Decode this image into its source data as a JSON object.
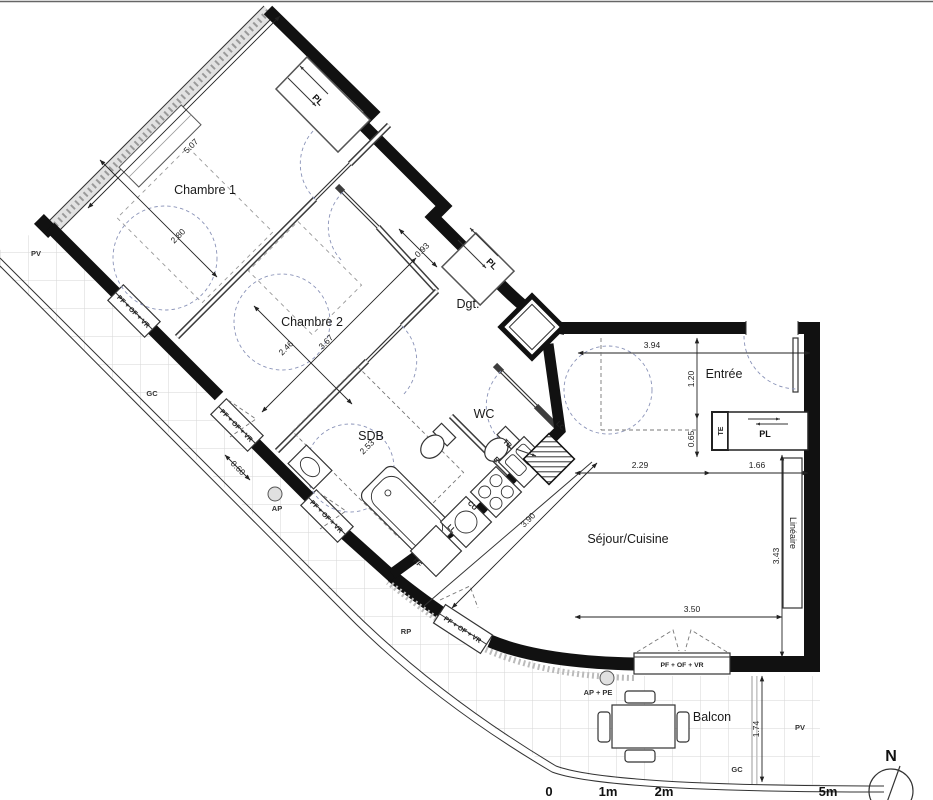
{
  "rooms": {
    "chambre1": "Chambre 1",
    "chambre2": "Chambre 2",
    "dgt": "Dgt.",
    "entree": "Entrée",
    "wc": "WC",
    "sdb": "SDB",
    "sejour": "Séjour/Cuisine",
    "balcon": "Balcon",
    "lineaire": "Linéaire"
  },
  "closets": {
    "pl": "PL",
    "te": "TE"
  },
  "dimensions": {
    "chambre1_length": "5.07",
    "chambre1_width": "2.80",
    "chambre2_width": "2.46",
    "chambre2_length": "3.67",
    "dgt_width": "0.93",
    "sdb_length": "2.53",
    "entree_width": "3.94",
    "entree_depth": "1.20",
    "entree_closet": "0.65",
    "sejour_left": "2.29",
    "sejour_right": "1.66",
    "sejour_height": "3.43",
    "sejour_width": "3.50",
    "kitchen_counter": "3.90",
    "wall_left": "0.60",
    "balcon_depth": "1.74"
  },
  "wall_labels": {
    "window": "PF + OF + VR",
    "pv": "PV",
    "gc": "GC",
    "ap": "AP",
    "ap_pe": "AP + PE",
    "rp": "RP"
  },
  "kitchen": {
    "lc": "LC",
    "tb": "TB",
    "e": "E",
    "cu": "CU",
    "ll": "LL",
    "rf": "RF"
  },
  "compass": {
    "north": "N"
  },
  "scale_bar": {
    "t0": "0",
    "t1": "1m",
    "t2": "2m",
    "t5": "5m"
  }
}
